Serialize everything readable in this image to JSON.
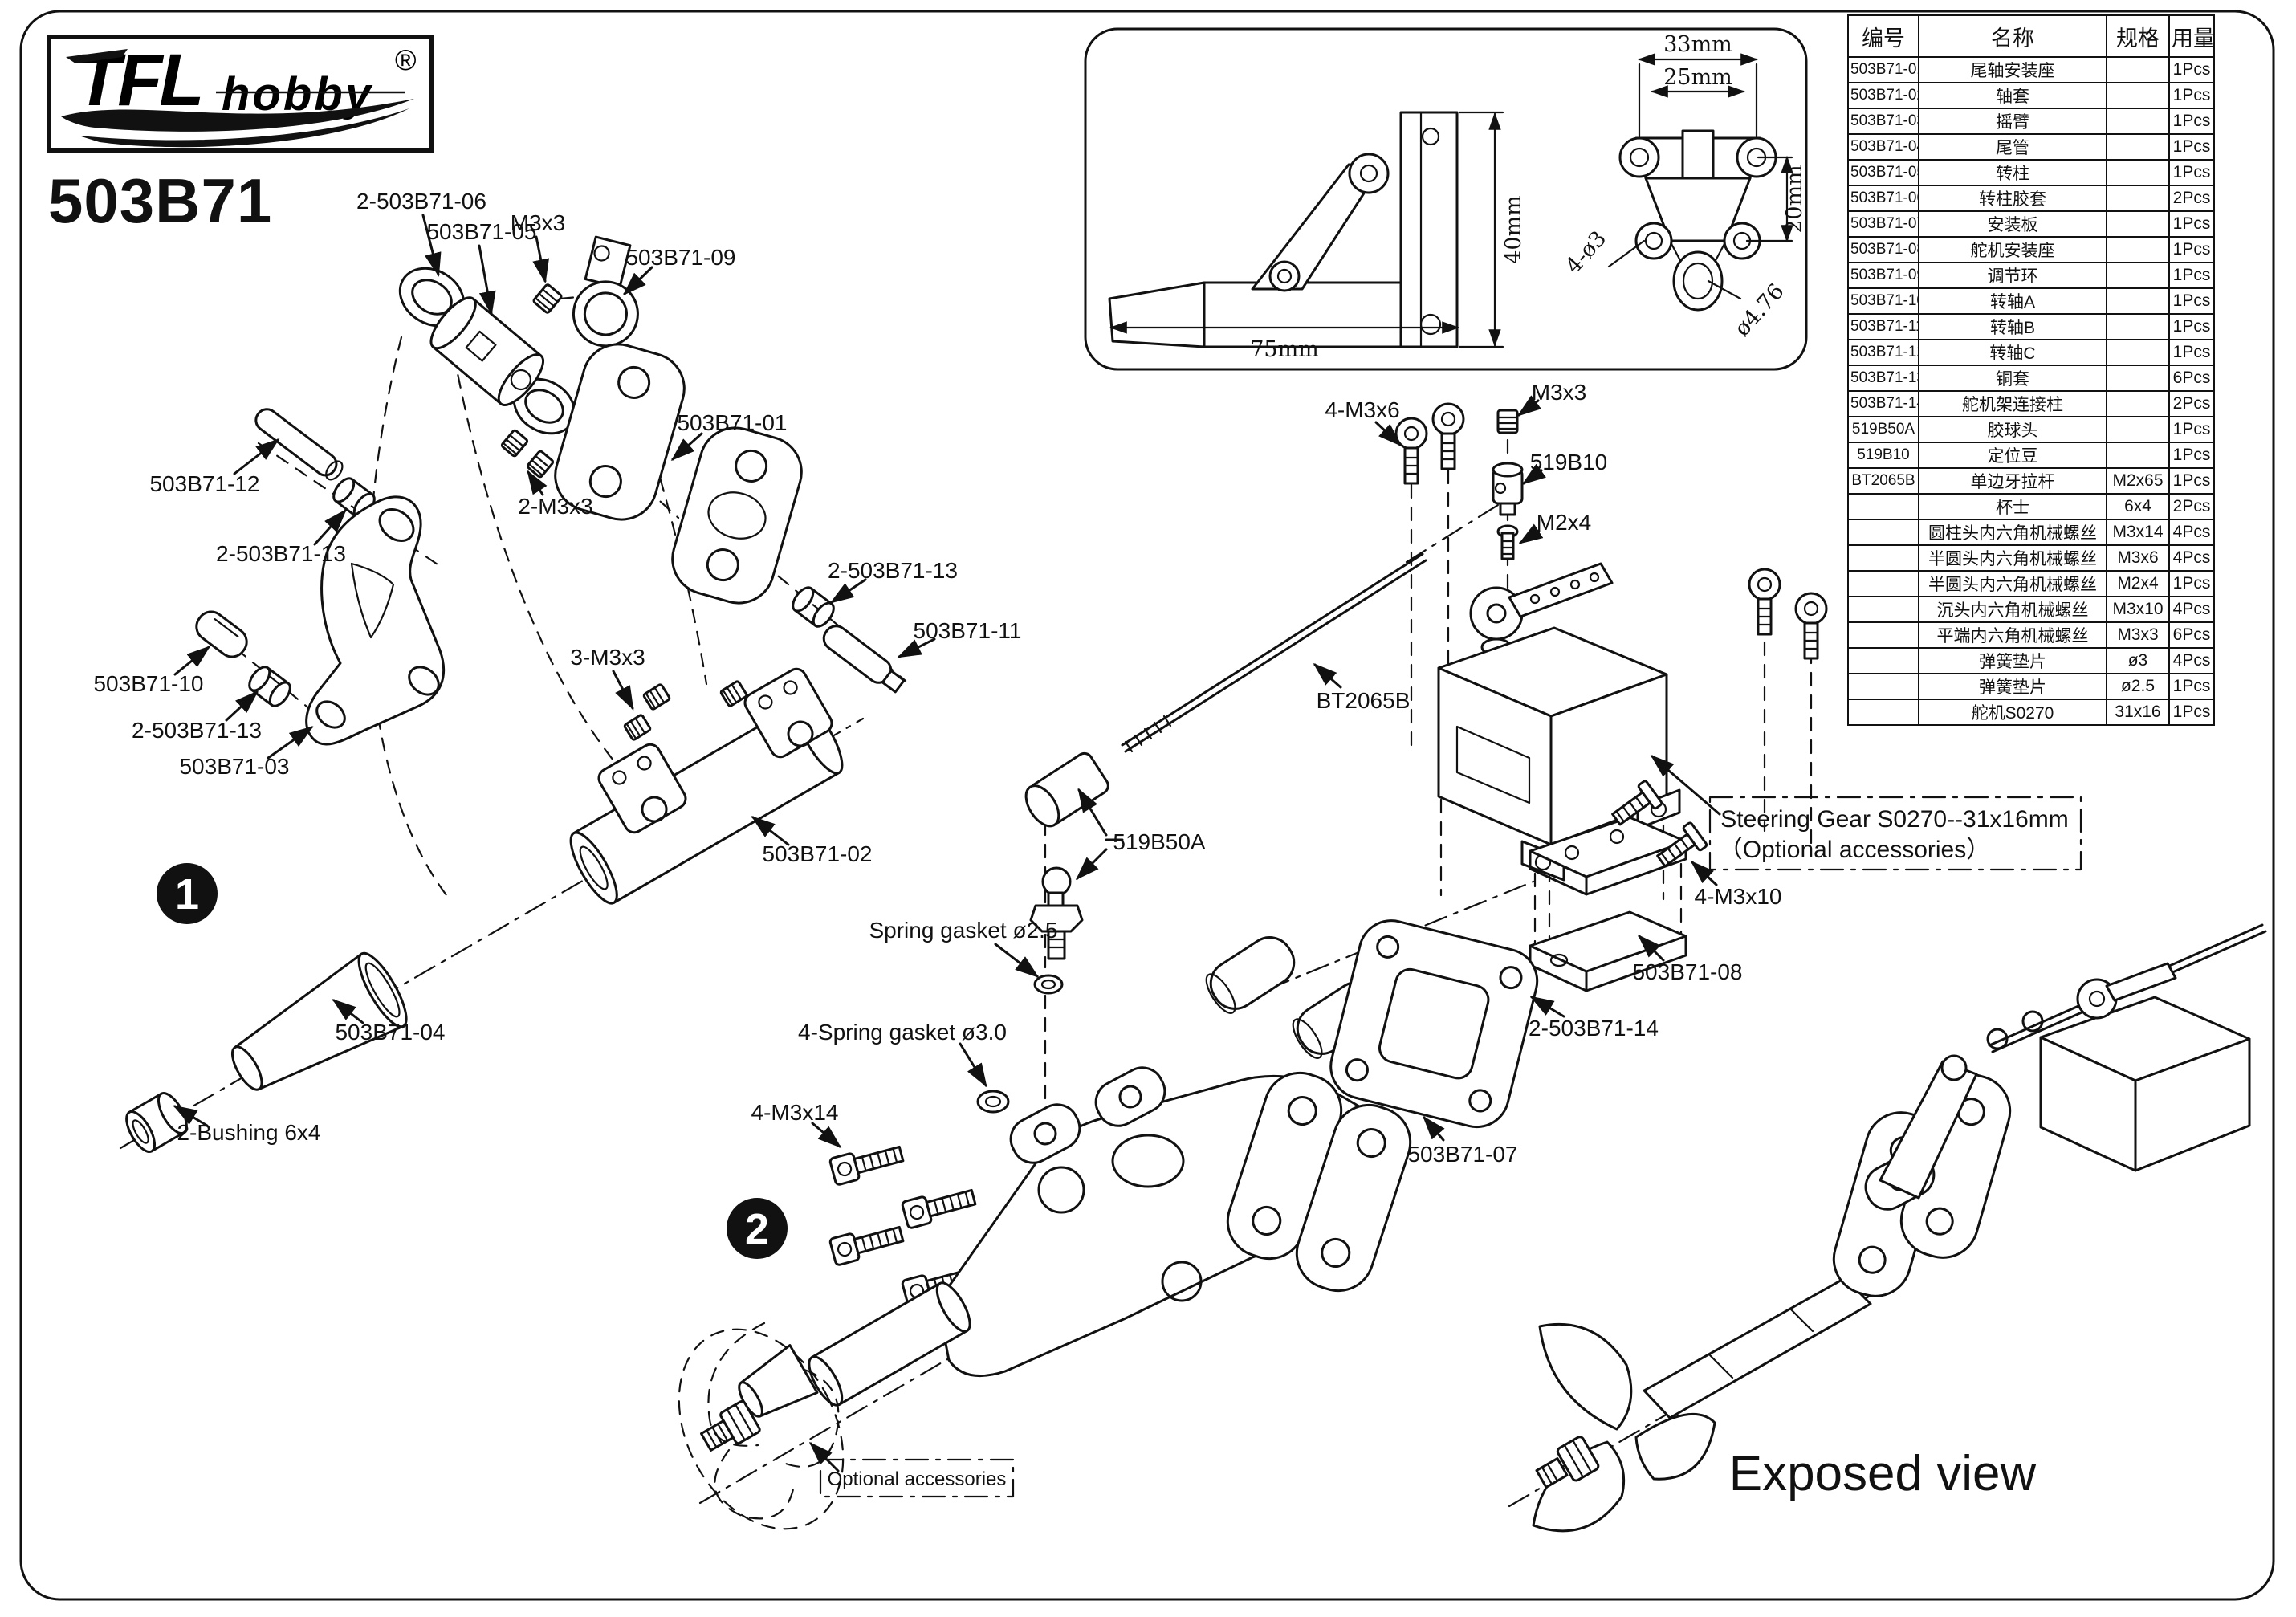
{
  "colors": {
    "ink": "#111111",
    "paper": "#ffffff"
  },
  "logo": {
    "brand": "TFL",
    "sub": "hobby",
    "reg": "®"
  },
  "title": "503B71",
  "steps": {
    "one": "1",
    "two": "2"
  },
  "inset_dims": {
    "w33": "33mm",
    "w25": "25mm",
    "h20": "20mm",
    "h40": "40mm",
    "w75": "75mm",
    "holes": "4-ø3",
    "bore": "ø4.76"
  },
  "callouts": {
    "s1": [
      "2-503B71-06",
      "503B71-05",
      "M3x3",
      "503B71-09",
      "503B71-01",
      "503B71-12",
      "2-503B71-13",
      "2-M3x3",
      "2-503B71-13",
      "503B71-11",
      "503B71-10",
      "2-503B71-13",
      "503B71-03",
      "3-M3x3",
      "503B71-02",
      "503B71-04",
      "2-Bushing 6x4"
    ],
    "s2": [
      "4-M3x6",
      "M3x3",
      "519B10",
      "M2x4",
      "BT2065B",
      "519B50A",
      "Spring gasket ø2.5",
      "4-Spring gasket ø3.0",
      "4-M3x14",
      "503B71-07",
      "2-503B71-14",
      "503B71-08",
      "4-M3x10"
    ]
  },
  "notes": {
    "steering_line1": "Steering Gear S0270--31x16mm",
    "steering_line2": "（Optional accessories）",
    "optional": "Optional accessories",
    "exposed": "Exposed view"
  },
  "table": {
    "headers": [
      "编号",
      "名称",
      "规格",
      "用量"
    ],
    "rows": [
      {
        "code": "503B71-01",
        "name": "尾轴安装座",
        "spec": "",
        "qty": "1Pcs"
      },
      {
        "code": "503B71-02",
        "name": "轴套",
        "spec": "",
        "qty": "1Pcs"
      },
      {
        "code": "503B71-03",
        "name": "摇臂",
        "spec": "",
        "qty": "1Pcs"
      },
      {
        "code": "503B71-04",
        "name": "尾管",
        "spec": "",
        "qty": "1Pcs"
      },
      {
        "code": "503B71-05",
        "name": "转柱",
        "spec": "",
        "qty": "1Pcs"
      },
      {
        "code": "503B71-06",
        "name": "转柱胶套",
        "spec": "",
        "qty": "2Pcs"
      },
      {
        "code": "503B71-07",
        "name": "安装板",
        "spec": "",
        "qty": "1Pcs"
      },
      {
        "code": "503B71-08",
        "name": "舵机安装座",
        "spec": "",
        "qty": "1Pcs"
      },
      {
        "code": "503B71-09",
        "name": "调节环",
        "spec": "",
        "qty": "1Pcs"
      },
      {
        "code": "503B71-10",
        "name": "转轴A",
        "spec": "",
        "qty": "1Pcs"
      },
      {
        "code": "503B71-11",
        "name": "转轴B",
        "spec": "",
        "qty": "1Pcs"
      },
      {
        "code": "503B71-12",
        "name": "转轴C",
        "spec": "",
        "qty": "1Pcs"
      },
      {
        "code": "503B71-13",
        "name": "铜套",
        "spec": "",
        "qty": "6Pcs"
      },
      {
        "code": "503B71-14",
        "name": "舵机架连接柱",
        "spec": "",
        "qty": "2Pcs"
      },
      {
        "code": "519B50A",
        "name": "胶球头",
        "spec": "",
        "qty": "1Pcs"
      },
      {
        "code": "519B10",
        "name": "定位豆",
        "spec": "",
        "qty": "1Pcs"
      },
      {
        "code": "BT2065B",
        "name": "单边牙拉杆",
        "spec": "M2x65",
        "qty": "1Pcs"
      },
      {
        "code": "",
        "name": "杯士",
        "spec": "6x4",
        "qty": "2Pcs"
      },
      {
        "code": "",
        "name": "圆柱头内六角机械螺丝",
        "spec": "M3x14",
        "qty": "4Pcs"
      },
      {
        "code": "",
        "name": "半圆头内六角机械螺丝",
        "spec": "M3x6",
        "qty": "4Pcs"
      },
      {
        "code": "",
        "name": "半圆头内六角机械螺丝",
        "spec": "M2x4",
        "qty": "1Pcs"
      },
      {
        "code": "",
        "name": "沉头内六角机械螺丝",
        "spec": "M3x10",
        "qty": "4Pcs"
      },
      {
        "code": "",
        "name": "平端内六角机械螺丝",
        "spec": "M3x3",
        "qty": "6Pcs"
      },
      {
        "code": "",
        "name": "弹簧垫片",
        "spec": "ø3",
        "qty": "4Pcs"
      },
      {
        "code": "",
        "name": "弹簧垫片",
        "spec": "ø2.5",
        "qty": "1Pcs"
      },
      {
        "code": "",
        "name": "舵机S0270",
        "spec": "31x16",
        "qty": "1Pcs"
      }
    ]
  }
}
